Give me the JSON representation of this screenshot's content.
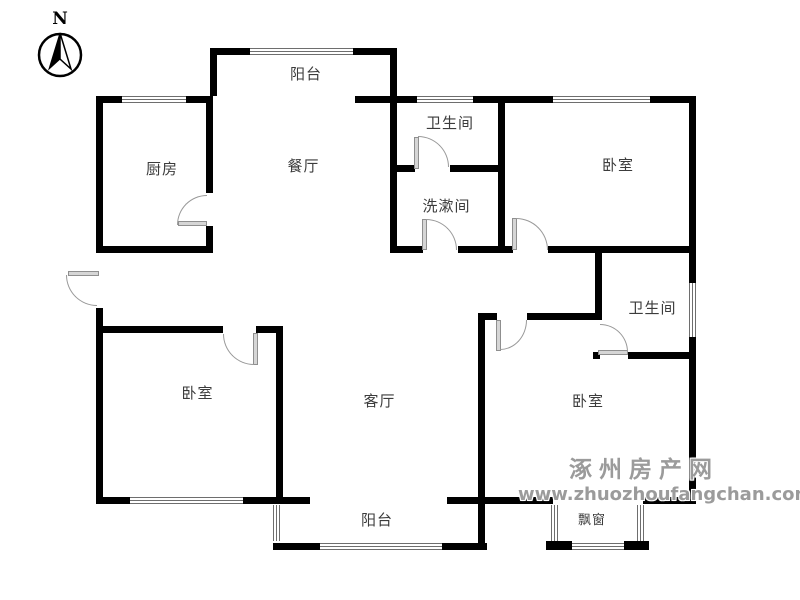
{
  "compass": {
    "label": "N"
  },
  "rooms": {
    "balcony_top": "阳台",
    "kitchen": "厨房",
    "dining": "餐厅",
    "bathroom_top": "卫生间",
    "bedroom_top_right": "卧室",
    "washroom": "洗漱间",
    "bathroom_right": "卫生间",
    "bedroom_left": "卧室",
    "living_room": "客厅",
    "bedroom_bottom_right": "卧室",
    "balcony_bottom": "阳台",
    "bay_window": "飘窗"
  },
  "watermark": {
    "site_name": "涿州房产网",
    "site_url": "www.zhuozhoufangchan.com",
    "text_color": "#9b9b9b"
  },
  "colors": {
    "wall": "#000000",
    "window_line": "#6e6e6e",
    "door_swing": "#999999",
    "label_text": "#3c3c3c"
  }
}
